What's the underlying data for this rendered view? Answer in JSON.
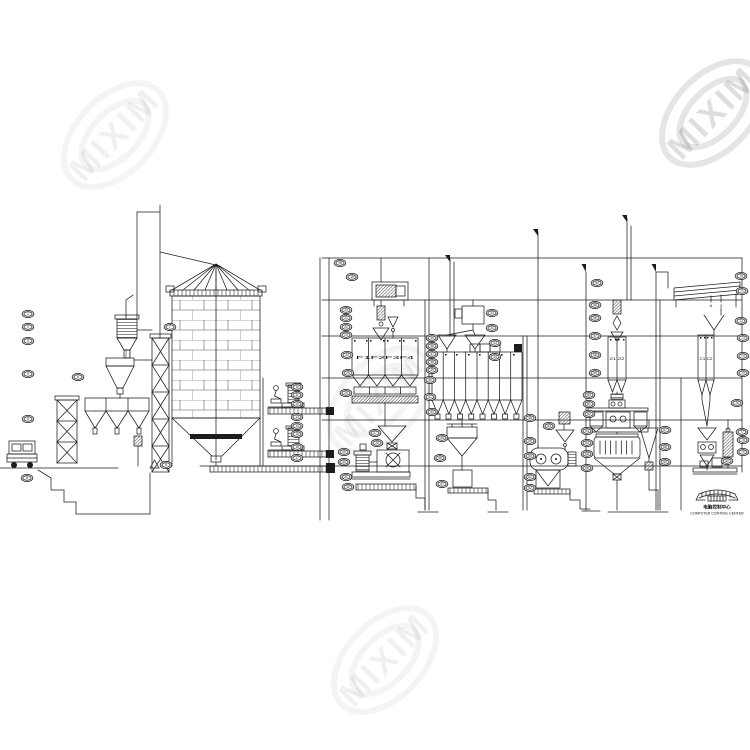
{
  "watermark": {
    "text": "MIXIM"
  },
  "labels": {
    "batching_bins": "F1F2F3F4",
    "pellet_bins": "21 22",
    "grading_bins": "C1 C2",
    "screen_output_a": "A",
    "screen_output_b": "3",
    "control_center_zh": "电脑控制中心",
    "control_center_en": "COMPUTER CONTROL CENTER"
  },
  "equipment_tags": [
    [
      28,
      314,
      "1"
    ],
    [
      28,
      327,
      "2"
    ],
    [
      28,
      341,
      "3"
    ],
    [
      28,
      374,
      "4"
    ],
    [
      28,
      419,
      "5"
    ],
    [
      78,
      377,
      "6"
    ],
    [
      170,
      327,
      "7"
    ],
    [
      27,
      478,
      "8"
    ],
    [
      166,
      465,
      "9"
    ],
    [
      297,
      387,
      "10"
    ],
    [
      297,
      395,
      "11"
    ],
    [
      297,
      404,
      "12"
    ],
    [
      297,
      417,
      "13"
    ],
    [
      297,
      426,
      "14"
    ],
    [
      297,
      434,
      "15"
    ],
    [
      297,
      447,
      "16"
    ],
    [
      297,
      458,
      "17"
    ],
    [
      340,
      263,
      "18"
    ],
    [
      352,
      277,
      "19"
    ],
    [
      346,
      310,
      "20"
    ],
    [
      346,
      318,
      "21"
    ],
    [
      346,
      327,
      "22"
    ],
    [
      346,
      335,
      "23"
    ],
    [
      347,
      355,
      "24"
    ],
    [
      348,
      373,
      "25"
    ],
    [
      346,
      393,
      "26"
    ],
    [
      375,
      433,
      "27"
    ],
    [
      377,
      443,
      "28"
    ],
    [
      344,
      452,
      "29"
    ],
    [
      344,
      462,
      "30"
    ],
    [
      346,
      477,
      "31"
    ],
    [
      348,
      487,
      "32"
    ],
    [
      492,
      313,
      "33"
    ],
    [
      492,
      328,
      "34"
    ],
    [
      432,
      338,
      "35"
    ],
    [
      432,
      346,
      "36"
    ],
    [
      432,
      354,
      "37"
    ],
    [
      432,
      362,
      "38"
    ],
    [
      432,
      370,
      "39"
    ],
    [
      430,
      380,
      "40"
    ],
    [
      430,
      397,
      "41"
    ],
    [
      432,
      412,
      "42"
    ],
    [
      495,
      343,
      "43"
    ],
    [
      495,
      357,
      "44"
    ],
    [
      442,
      438,
      "45"
    ],
    [
      440,
      458,
      "46"
    ],
    [
      442,
      484,
      "47"
    ],
    [
      530,
      418,
      "48"
    ],
    [
      530,
      441,
      "49"
    ],
    [
      530,
      456,
      "50"
    ],
    [
      530,
      477,
      "51"
    ],
    [
      530,
      488,
      "52"
    ],
    [
      549,
      426,
      "53"
    ],
    [
      597,
      283,
      "54"
    ],
    [
      595,
      305,
      "55"
    ],
    [
      595,
      318,
      "56"
    ],
    [
      595,
      336,
      "57"
    ],
    [
      595,
      355,
      "58"
    ],
    [
      595,
      373,
      "59"
    ],
    [
      589,
      395,
      "60"
    ],
    [
      589,
      404,
      "61"
    ],
    [
      589,
      414,
      "62"
    ],
    [
      587,
      431,
      "63"
    ],
    [
      587,
      443,
      "64"
    ],
    [
      587,
      454,
      "65"
    ],
    [
      587,
      468,
      "66"
    ],
    [
      665,
      430,
      "67"
    ],
    [
      665,
      447,
      "68"
    ],
    [
      665,
      462,
      "69"
    ],
    [
      741,
      276,
      "70"
    ],
    [
      742,
      291,
      "71"
    ],
    [
      741,
      321,
      "72"
    ],
    [
      743,
      338,
      "73"
    ],
    [
      743,
      356,
      "74"
    ],
    [
      743,
      373,
      "75"
    ],
    [
      737,
      403,
      "76"
    ],
    [
      742,
      432,
      "77"
    ],
    [
      743,
      440,
      "78"
    ],
    [
      743,
      452,
      "79"
    ],
    [
      727,
      461,
      "80"
    ]
  ]
}
